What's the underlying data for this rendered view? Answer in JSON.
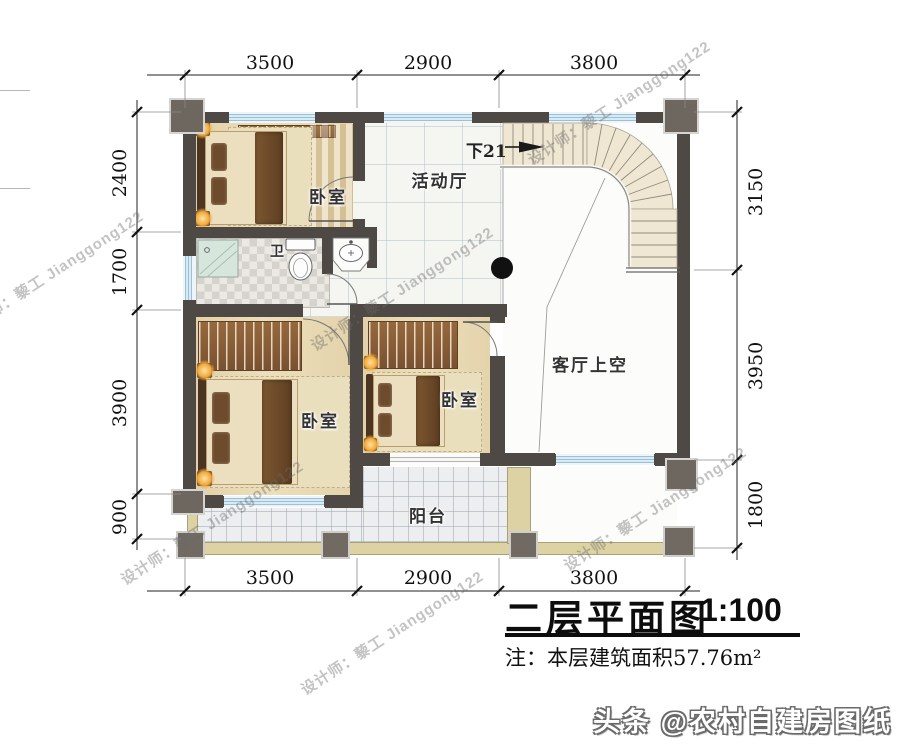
{
  "watermark": {
    "text": "设计师：藜工 Jianggong122"
  },
  "credit": {
    "text": "头条 @农村自建房图纸"
  },
  "plan": {
    "rooms": {
      "bedroom_top": "卧室",
      "bedroom_left": "卧室",
      "bedroom_mid": "卧室",
      "hall": "活动厅",
      "bath": "卫",
      "living_void": "客厅上空",
      "balcony": "阳台"
    },
    "stair_note": "下21"
  },
  "dimensions": {
    "top": [
      "3500",
      "2900",
      "3800"
    ],
    "bottom": [
      "3500",
      "2900",
      "3800"
    ],
    "left": [
      "2400",
      "1700",
      "3900",
      "900"
    ],
    "right": [
      "3150",
      "3950",
      "1800"
    ]
  },
  "titleblock": {
    "title": "二层平面图",
    "scale": "1:100",
    "note": "注：本层建筑面积57.76m²"
  },
  "colors": {
    "wall": "#4e4944",
    "window_glass": "#cfe2ee",
    "parapet": "#dcd2a4",
    "floor_wood": "#e7d7b2",
    "stair_tread": "#f0e7d2",
    "lamp_glow": "#f0a83c"
  }
}
